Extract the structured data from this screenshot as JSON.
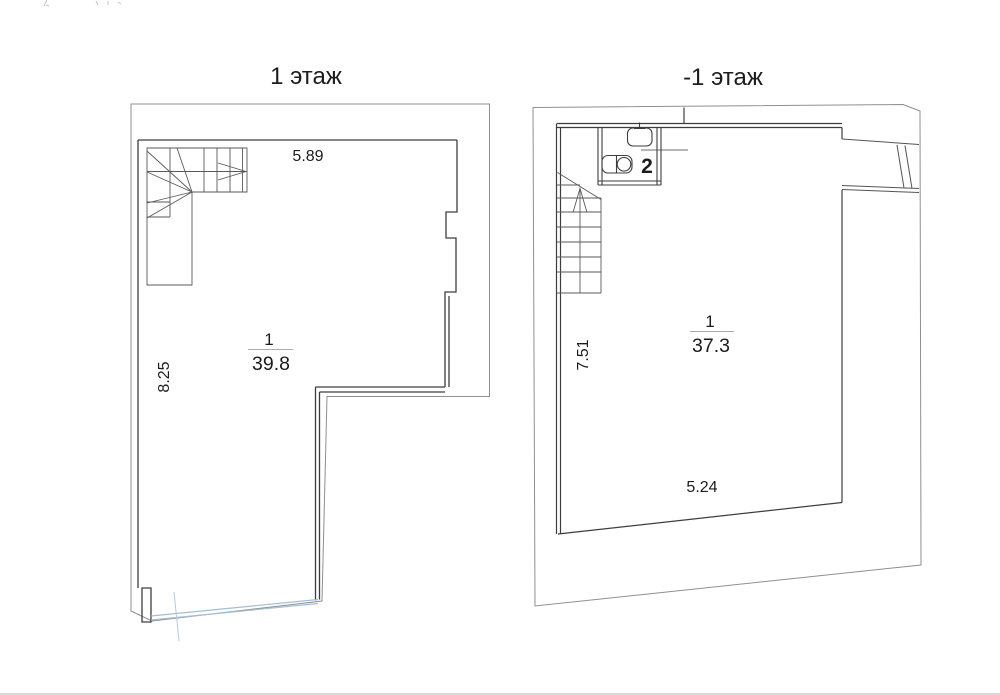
{
  "document": {
    "kind": "apartment floor plan drawing",
    "background": "#ffffff"
  },
  "colors": {
    "wall": "#3d3d3d",
    "stair_line": "#5a5a5a",
    "outer_boundary": "#8f8f8f",
    "glazing_blue": "#a3bed2",
    "axis_blue": "#b3c9da",
    "text": "#1c1c1c",
    "fraction_line": "#adadad"
  },
  "floor1": {
    "title": "1 этаж",
    "dim_top": "5.89",
    "dim_left": "8.25",
    "room": {
      "number": "1",
      "area": "39.8"
    }
  },
  "floorMinus1": {
    "title": "-1 этаж",
    "dim_left": "7.51",
    "dim_bottom": "5.24",
    "room": {
      "number": "1",
      "area": "37.3"
    },
    "bathroom": {
      "number": "2"
    }
  }
}
